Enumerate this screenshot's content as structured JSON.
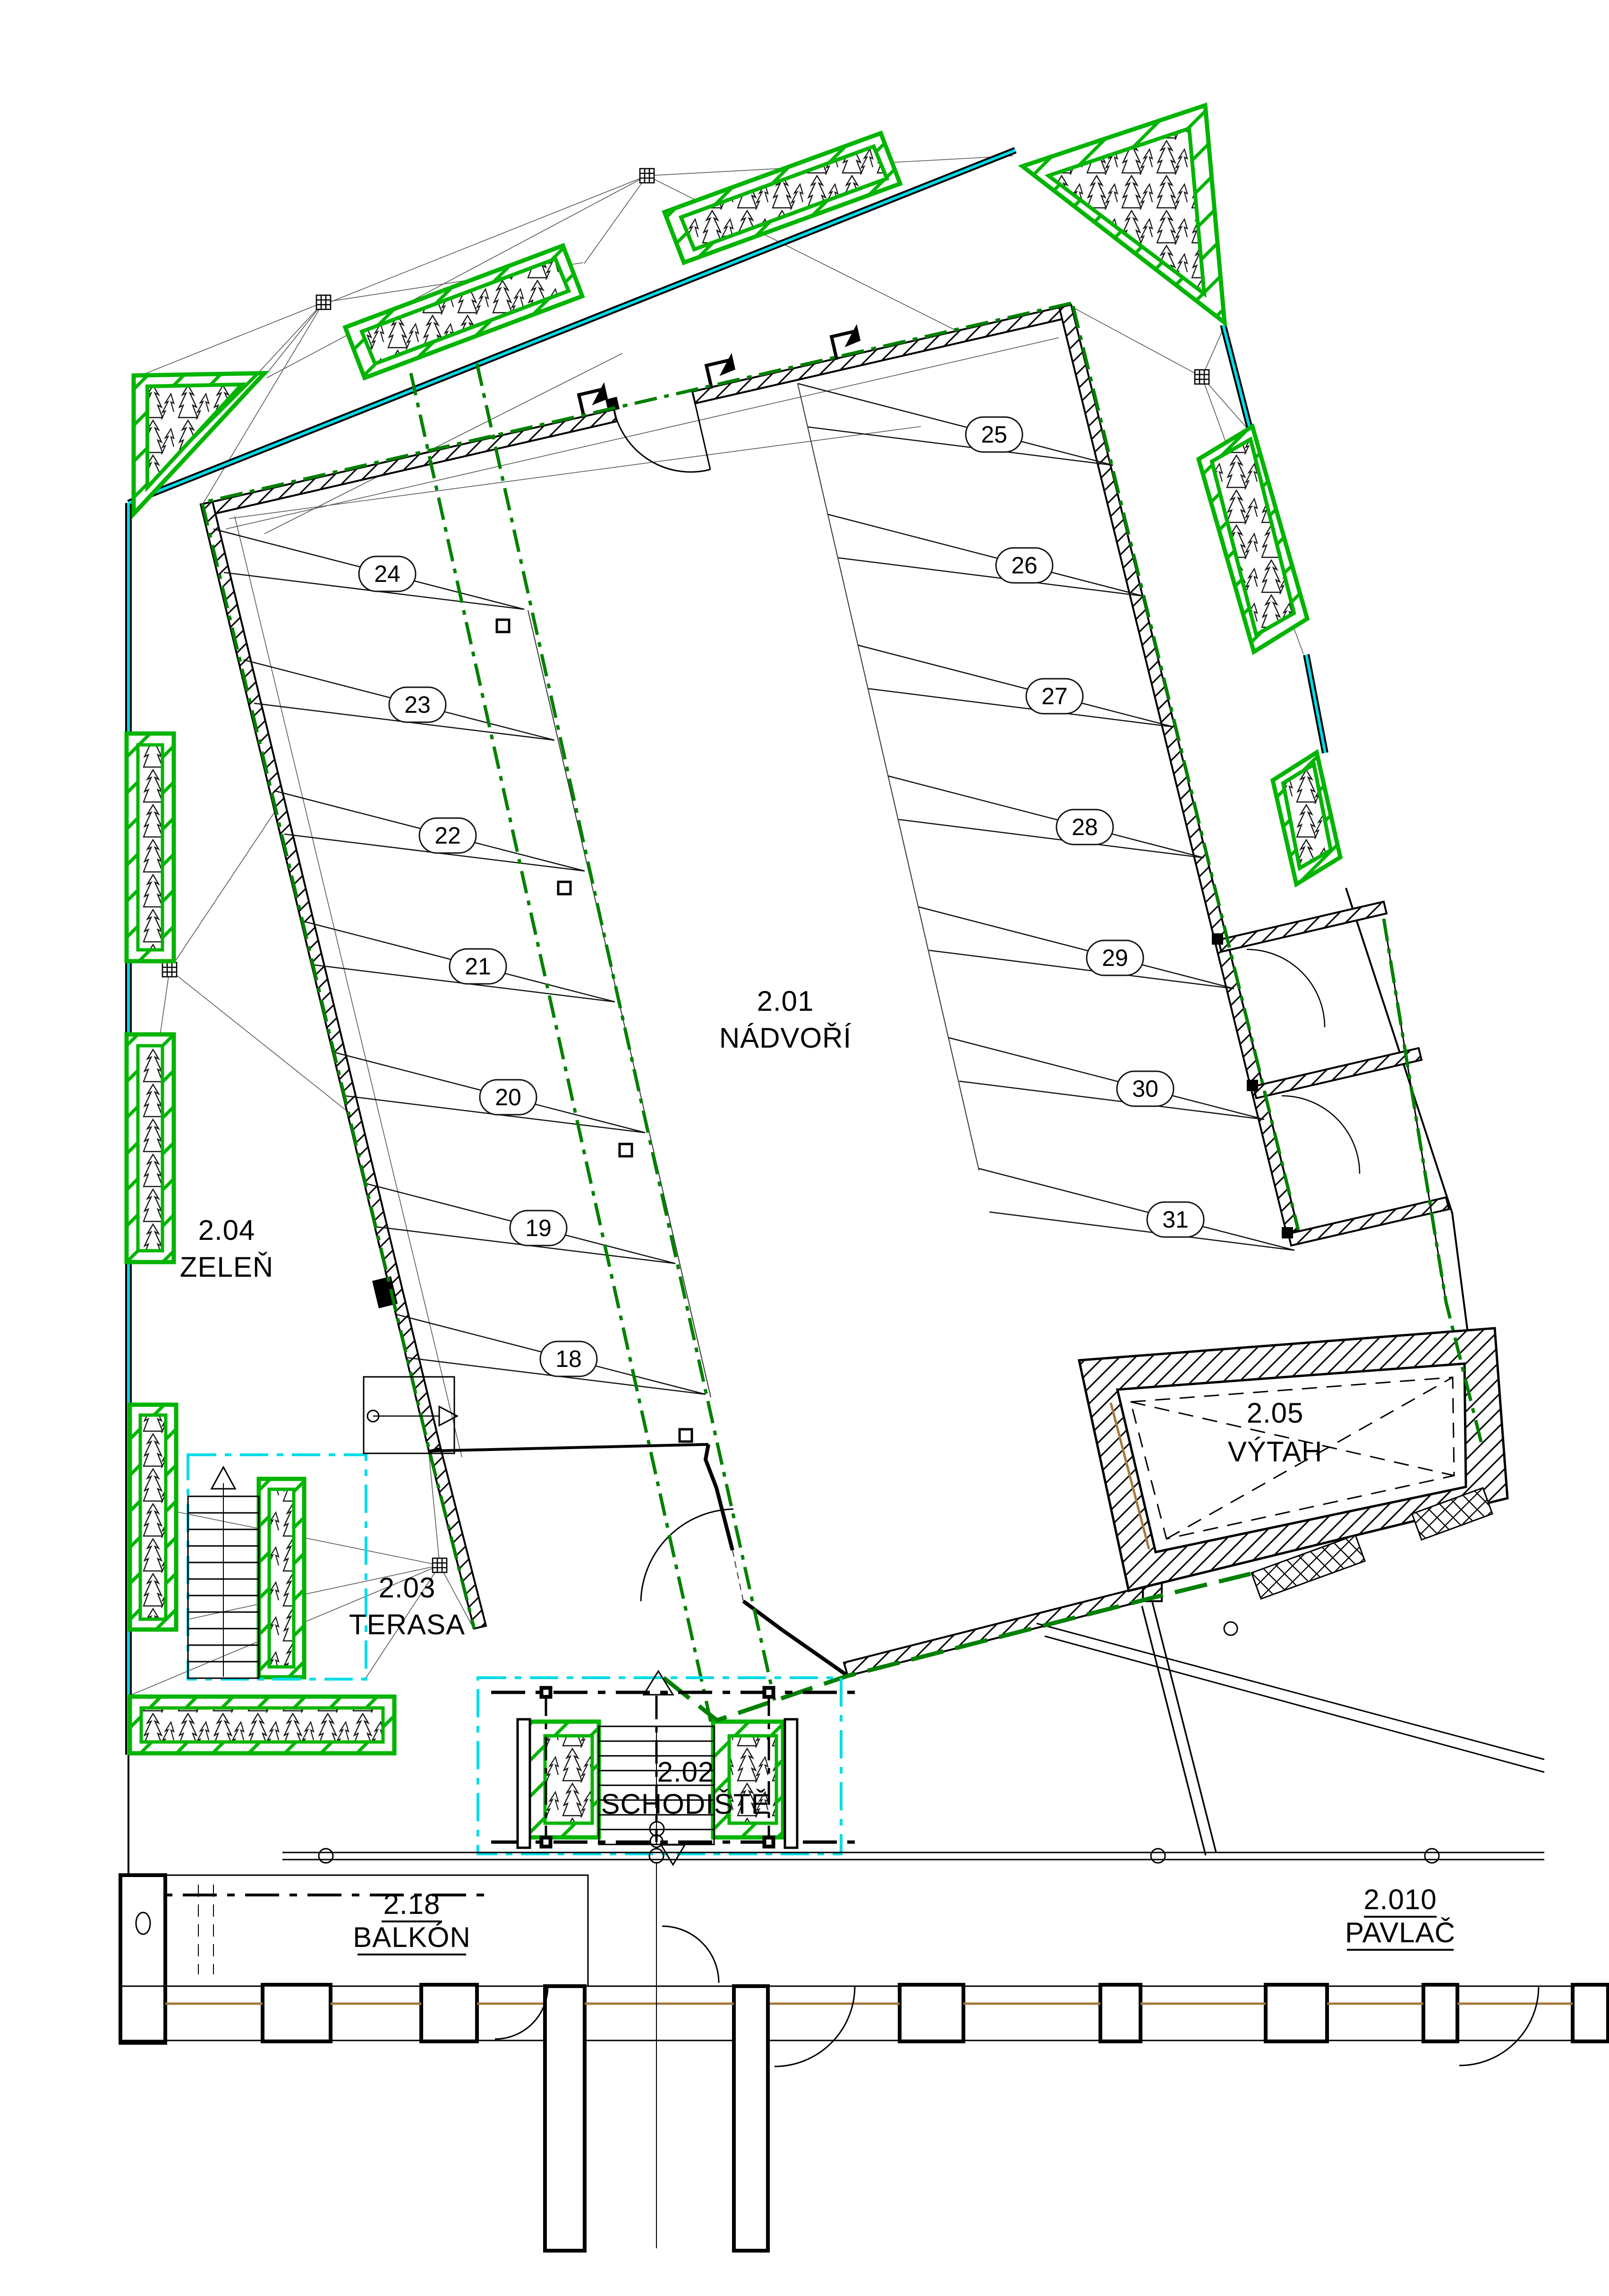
{
  "drawing_type": "floor-plan",
  "rooms": {
    "nadvori": {
      "id": "2.01",
      "name": "NÁDVOŘÍ"
    },
    "schodiste": {
      "id": "2.02",
      "name": "SCHODIŠTĚ"
    },
    "terasa": {
      "id": "2.03",
      "name": "TERASA"
    },
    "zelen": {
      "id": "2.04",
      "name": "ZELEŇ"
    },
    "vytah": {
      "id": "2.05",
      "name": "VÝTAH"
    },
    "balkon": {
      "id": "2.18",
      "name": "BALKÓN"
    },
    "pavlac": {
      "id": "2.010",
      "name": "PAVLAČ"
    }
  },
  "parking": {
    "left_column": [
      "24",
      "23",
      "22",
      "21",
      "20",
      "19",
      "18"
    ],
    "right_column": [
      "25",
      "26",
      "27",
      "28",
      "29",
      "30",
      "31"
    ]
  },
  "colors": {
    "planter_green": "#00b400",
    "dash_green": "#008000",
    "railing_cyan": "#00dce8",
    "wall_black": "#000000",
    "sill_brown": "#a5783c"
  }
}
